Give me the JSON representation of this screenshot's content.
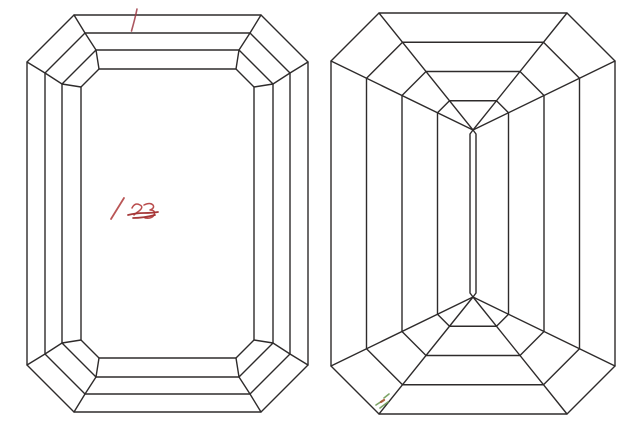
{
  "canvas": {
    "width": 640,
    "height": 430,
    "background": "#ffffff"
  },
  "style": {
    "line_color": "#2e2b2b",
    "line_width": 1.4
  },
  "diagram": {
    "subject": "emerald-cut-diamond-facet-diagram",
    "crown_view": {
      "bounds": {
        "left": 27,
        "right": 308,
        "top": 15,
        "bottom": 412
      },
      "insets": [
        0,
        18,
        35,
        54
      ],
      "chamfers": [
        47,
        40,
        34,
        18
      ]
    },
    "pavilion_view": {
      "bounds": {
        "left": 331,
        "right": 615,
        "top": 13,
        "bottom": 414
      },
      "chamfer": 48,
      "ring_ts": [
        0.25,
        0.5,
        0.75
      ],
      "keel": {
        "x": 473,
        "top": 130,
        "bottom": 297,
        "half_width": 3,
        "taper": 4
      }
    }
  },
  "annotations": [
    {
      "name": "red-tick-mark",
      "color": "#9e3a44",
      "width": 1.6,
      "opacity": 0.85,
      "path": "M137,9 C136,14 133.5,24 131.5,31"
    },
    {
      "name": "red-slash",
      "color": "#b24444",
      "width": 1.8,
      "opacity": 0.9,
      "path": "M124,198 L111,219"
    },
    {
      "name": "red-scribble-a",
      "color": "#b23a3a",
      "width": 1.5,
      "opacity": 0.9,
      "path": "M132,208 q3,-6 8,-3 q4,2 -1,6 q-3,2 -5,4"
    },
    {
      "name": "red-scribble-b",
      "color": "#b23a3a",
      "width": 1.5,
      "opacity": 0.9,
      "path": "M144,205 q6,-3 9,0 q2,3 -3,5 q6,0 4,5 q-2,4 -9,3"
    },
    {
      "name": "red-scribble-strike",
      "color": "#a12f2f",
      "width": 1.7,
      "opacity": 0.95,
      "path": "M128,215 q8,-2 16,-2 t14,-1 M133,218 q10,0 22,-3"
    },
    {
      "name": "green-smudge-strokes",
      "color": "#6f9a55",
      "width": 1.6,
      "opacity": 0.9,
      "path": "M376,405 l6,-4 M380,408 l8,-6 M384,398 l5,-4"
    },
    {
      "name": "smudge-red-dot",
      "color": "#a8522e",
      "width": 2.2,
      "opacity": 0.9,
      "path": "M381,402 l3,-2"
    }
  ]
}
